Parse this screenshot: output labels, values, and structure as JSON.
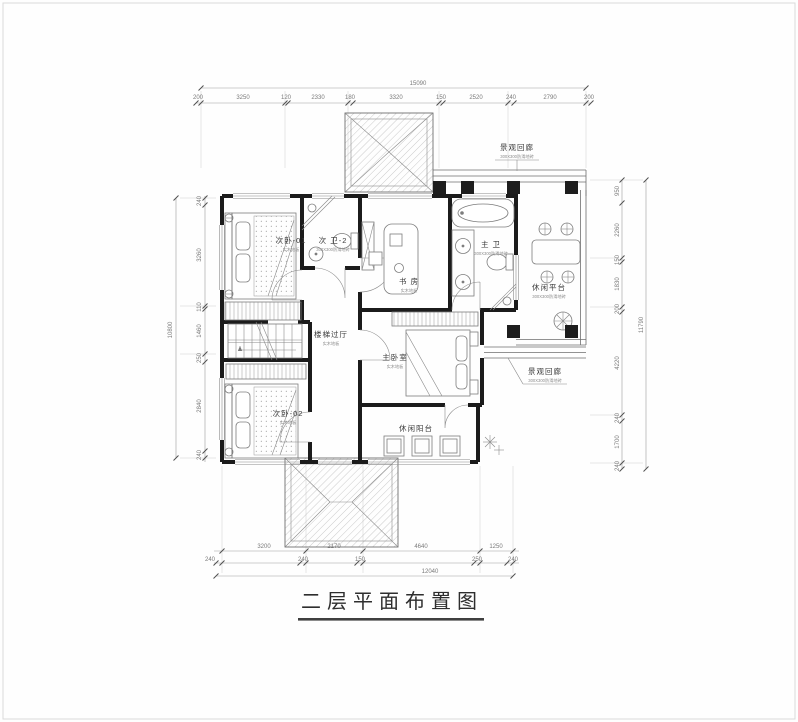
{
  "title": {
    "text": "二层平面布置图"
  },
  "rooms": {
    "bedroom1": {
      "label": "次卧-01",
      "sub": "实木地板"
    },
    "bath2": {
      "label": "次 卫-2",
      "sub": "300X300防滑地砖"
    },
    "study": {
      "label": "书 房",
      "sub": "实木地板"
    },
    "masterBath": {
      "label": "主 卫",
      "sub": "300X300防滑地砖"
    },
    "terrace": {
      "label": "休闲平台",
      "sub": "300X300防滑地砖"
    },
    "corridorTop": {
      "label": "景观回廊",
      "sub": "300X300防滑地砖"
    },
    "stairHall": {
      "label": "楼梯过厅",
      "sub": "实木地板"
    },
    "masterBedroom": {
      "label": "主卧室",
      "sub": "实木地板"
    },
    "bedroom2": {
      "label": "次卧-02",
      "sub": "实木地板"
    },
    "balcony": {
      "label": "休闲阳台",
      "sub": ""
    },
    "corridorRight": {
      "label": "景观回廊",
      "sub": "300X300防滑地砖"
    }
  },
  "dimensions": {
    "top": {
      "overall": "15090",
      "segments": [
        "200",
        "3250",
        "120",
        "2330",
        "180",
        "3320",
        "150",
        "2520",
        "240",
        "2790",
        "200"
      ]
    },
    "bottom": {
      "overall": "12040",
      "row1": [
        "3200",
        "2170",
        "4640",
        "1250"
      ],
      "row2": [
        "240",
        "240",
        "150",
        "250",
        "240"
      ]
    },
    "left": {
      "overall": "10800",
      "segments": [
        "240",
        "3260",
        "110",
        "1460",
        "250",
        "2840",
        "240"
      ]
    },
    "right": {
      "overall": "11790",
      "segments": [
        "950",
        "2260",
        "150",
        "1830",
        "200",
        "4220",
        "240",
        "1700",
        "240"
      ]
    }
  },
  "colors": {
    "wall": "#1b1b1b",
    "line": "#8a8a8a",
    "dim_text": "#7a7a7a",
    "paper": "#fefefe"
  }
}
